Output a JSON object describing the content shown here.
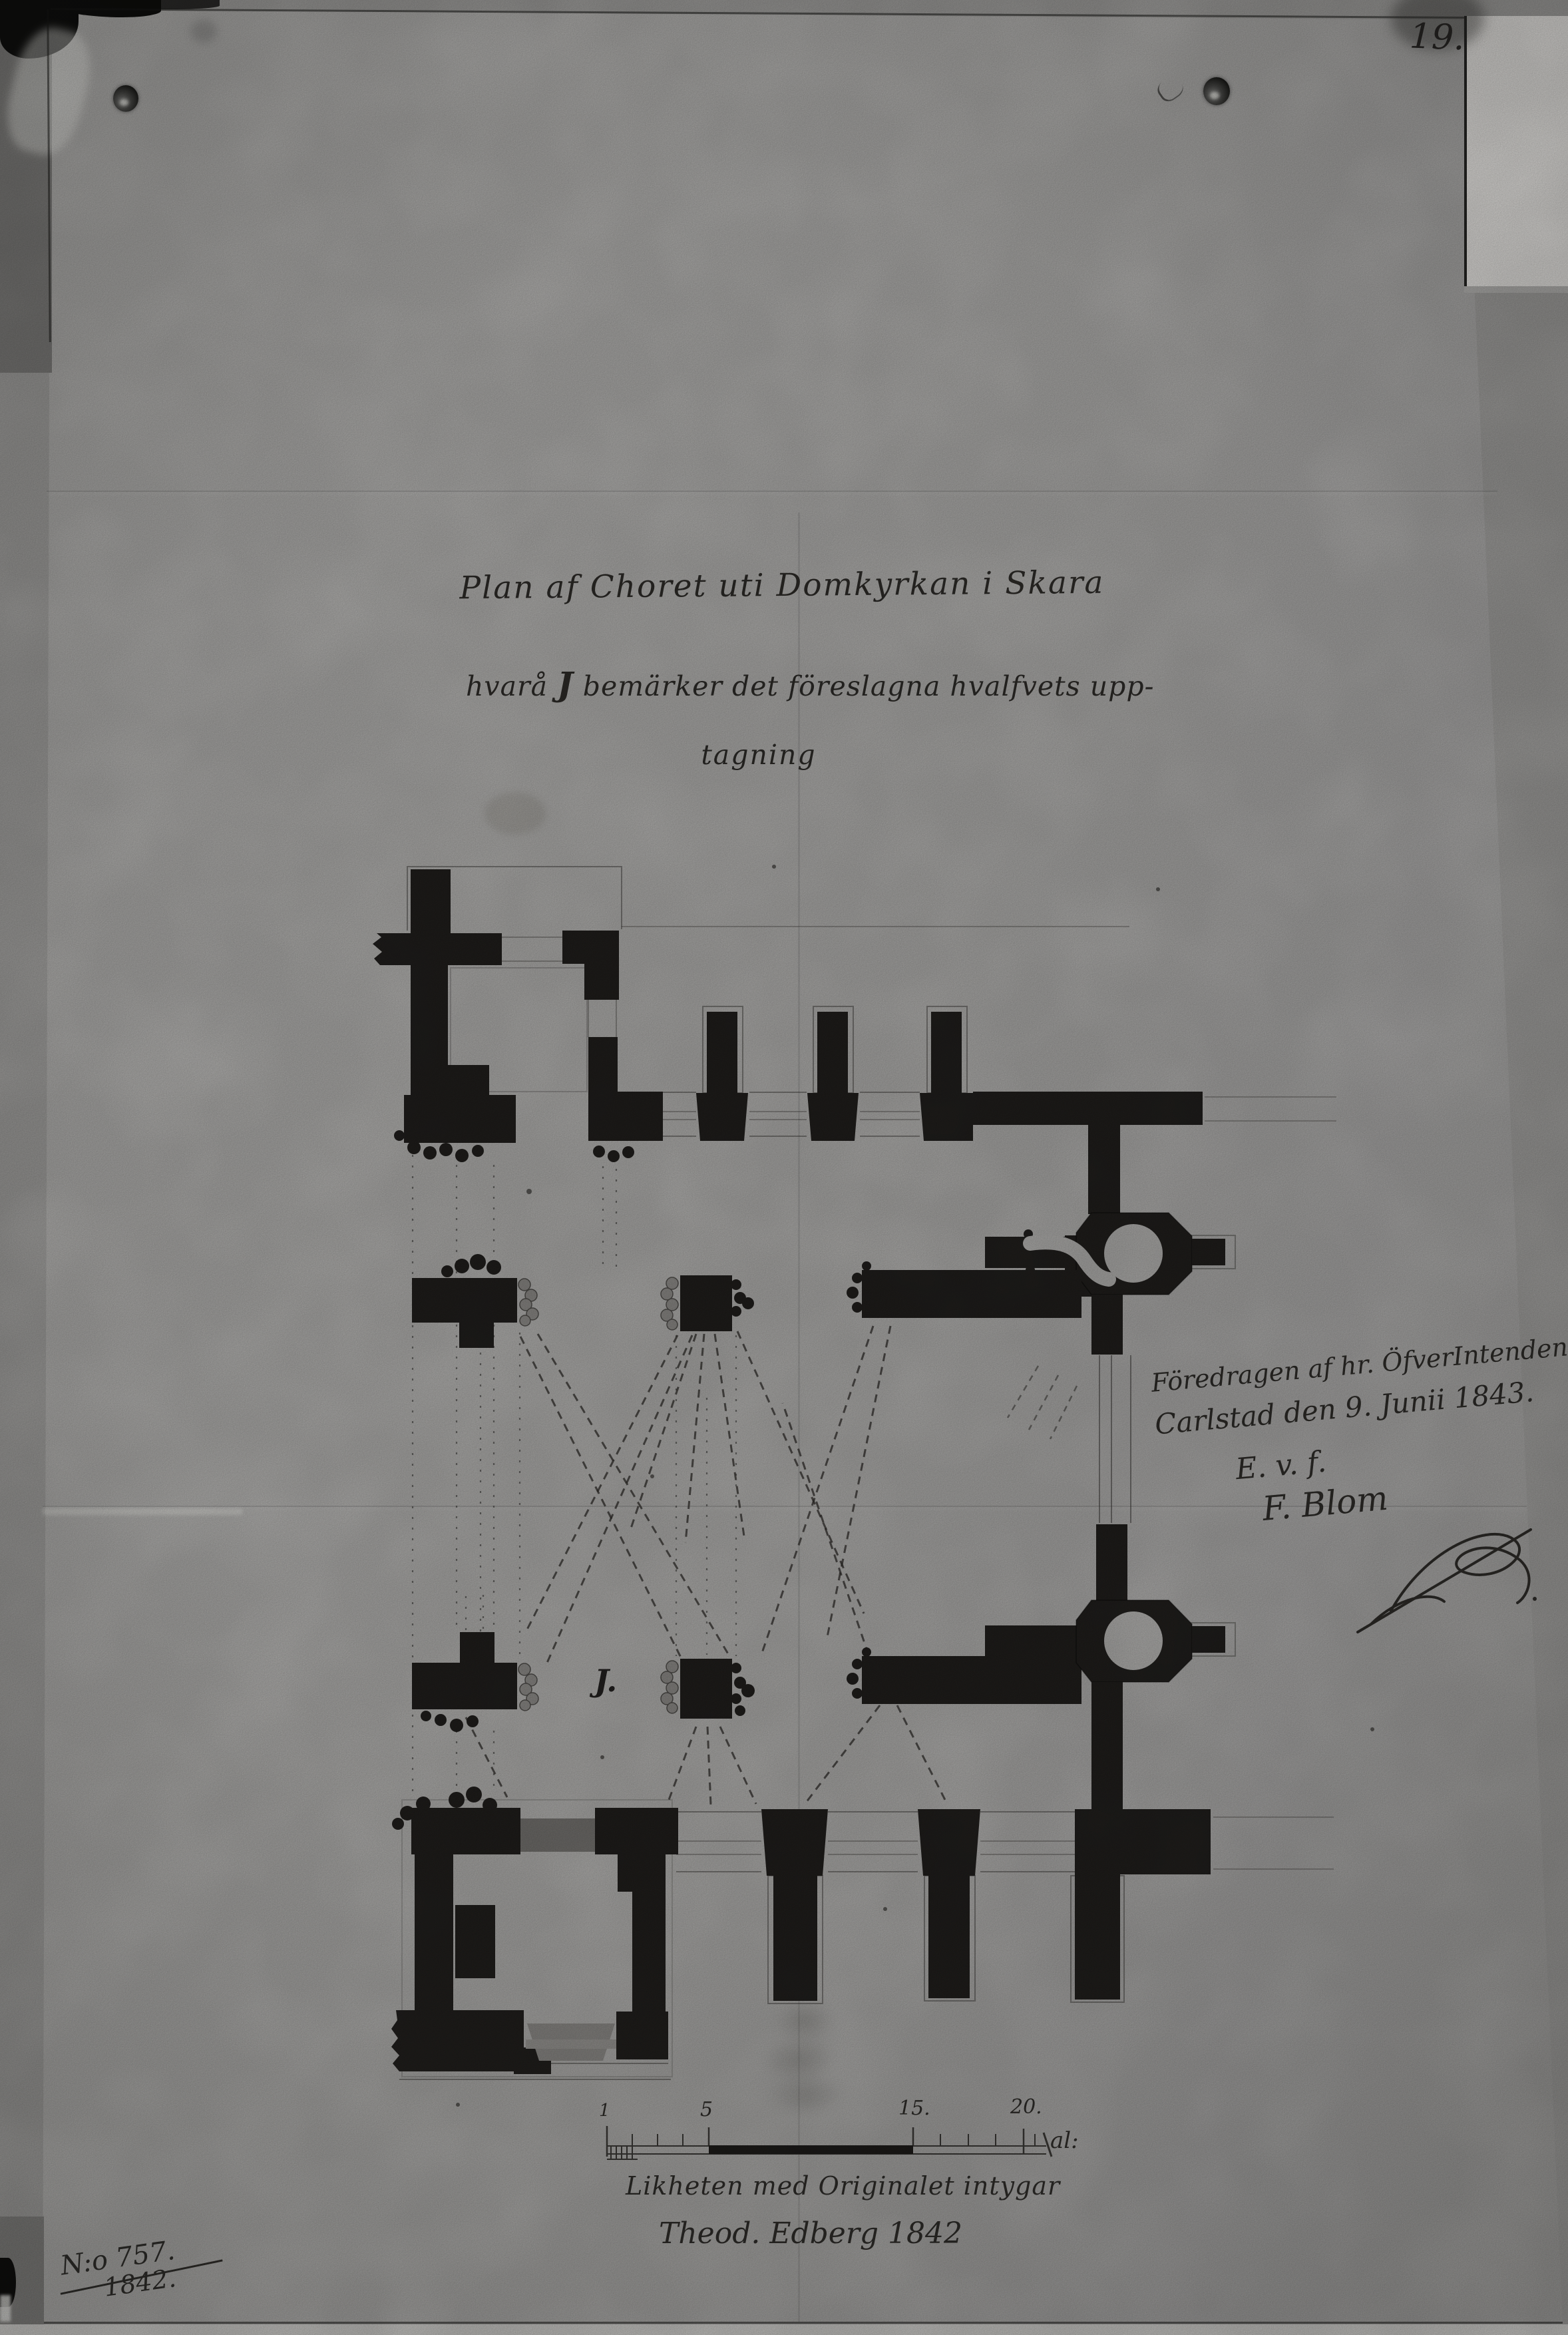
{
  "page": {
    "number": "19."
  },
  "title": {
    "line1": "Plan af Choret uti Domkyrkan i Skara",
    "line2_pre": "hvarå ",
    "line2_j": "J",
    "line2_post": " bemärker det föreslagna hvalfvets upp-",
    "line3": "tagning"
  },
  "plan": {
    "vault_label": "J."
  },
  "annotation": {
    "line1": "Föredragen af hr. ÖfverIntendenten,",
    "line2": "Carlstad den 9. Junii 1843.",
    "line3": "E. v. f.",
    "line4": "F. Blom"
  },
  "scale_bar": {
    "tick1": "1",
    "tick5": "5",
    "tick15": "15.",
    "tick20": "20.",
    "unit": "al:"
  },
  "attestation": {
    "line1": "Likheten med Originalet intygar",
    "line2": "Theod. Edberg 1842"
  },
  "archive": {
    "number": "N:o 757.",
    "year": "1842."
  }
}
